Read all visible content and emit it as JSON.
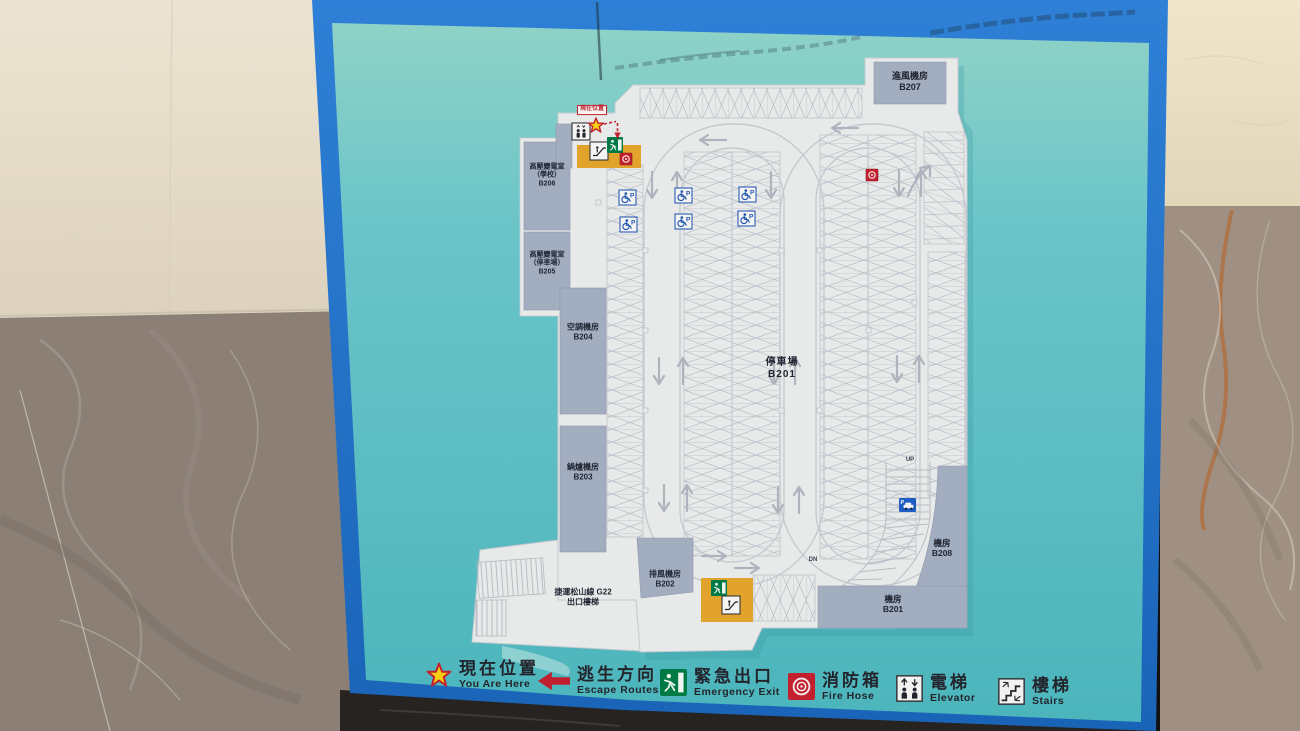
{
  "legend": {
    "items": [
      {
        "id": "you-are-here",
        "icon": "star-icon",
        "zh": "現在位置",
        "en": "You Are Here"
      },
      {
        "id": "escape-routes",
        "icon": "arrow-left-icon",
        "zh": "逃生方向",
        "en": "Escape Routes"
      },
      {
        "id": "emergency-exit",
        "icon": "exit-icon",
        "zh": "緊急出口",
        "en": "Emergency Exit"
      },
      {
        "id": "fire-hose",
        "icon": "fire-hose-icon",
        "zh": "消防箱",
        "en": "Fire Hose"
      },
      {
        "id": "elevator",
        "icon": "elevator-icon",
        "zh": "電梯",
        "en": "Elevator"
      },
      {
        "id": "stairs",
        "icon": "stairs-icon",
        "zh": "樓梯",
        "en": "Stairs"
      }
    ]
  },
  "rooms": {
    "b207": {
      "name": "進風機房",
      "code": "B207"
    },
    "b206": {
      "name": "高壓變電室",
      "sub": "（學校）",
      "code": "B206"
    },
    "b205": {
      "name": "高壓變電室",
      "sub": "（停車場）",
      "code": "B205"
    },
    "b204": {
      "name": "空調機房",
      "code": "B204"
    },
    "b203": {
      "name": "鍋爐機房",
      "code": "B203"
    },
    "parking": {
      "name": "停車場",
      "code": "B201"
    },
    "b202": {
      "name": "排風機房",
      "code": "B202"
    },
    "b208": {
      "name": "機房",
      "code": "B208"
    },
    "b201_room": {
      "name": "機房",
      "code": "B201"
    }
  },
  "map_labels": {
    "mrt_line1": "捷運松山線  G22",
    "mrt_line2": "出口樓梯",
    "you_are_here_tag": "現在位置",
    "ramp_up": "UP",
    "ramp_dn": "DN",
    "parking_p": "P"
  },
  "colors": {
    "board_frame_blue": "#1d6fc6",
    "board_teal": "#5fc0c6",
    "plan_white": "#e8e9e9",
    "room_gray": "#a3adc0",
    "escalator_yellow": "#e2a32c",
    "alert_red": "#c3202e",
    "exit_green": "#007a45",
    "accessible_blue": "#1d53b0"
  }
}
